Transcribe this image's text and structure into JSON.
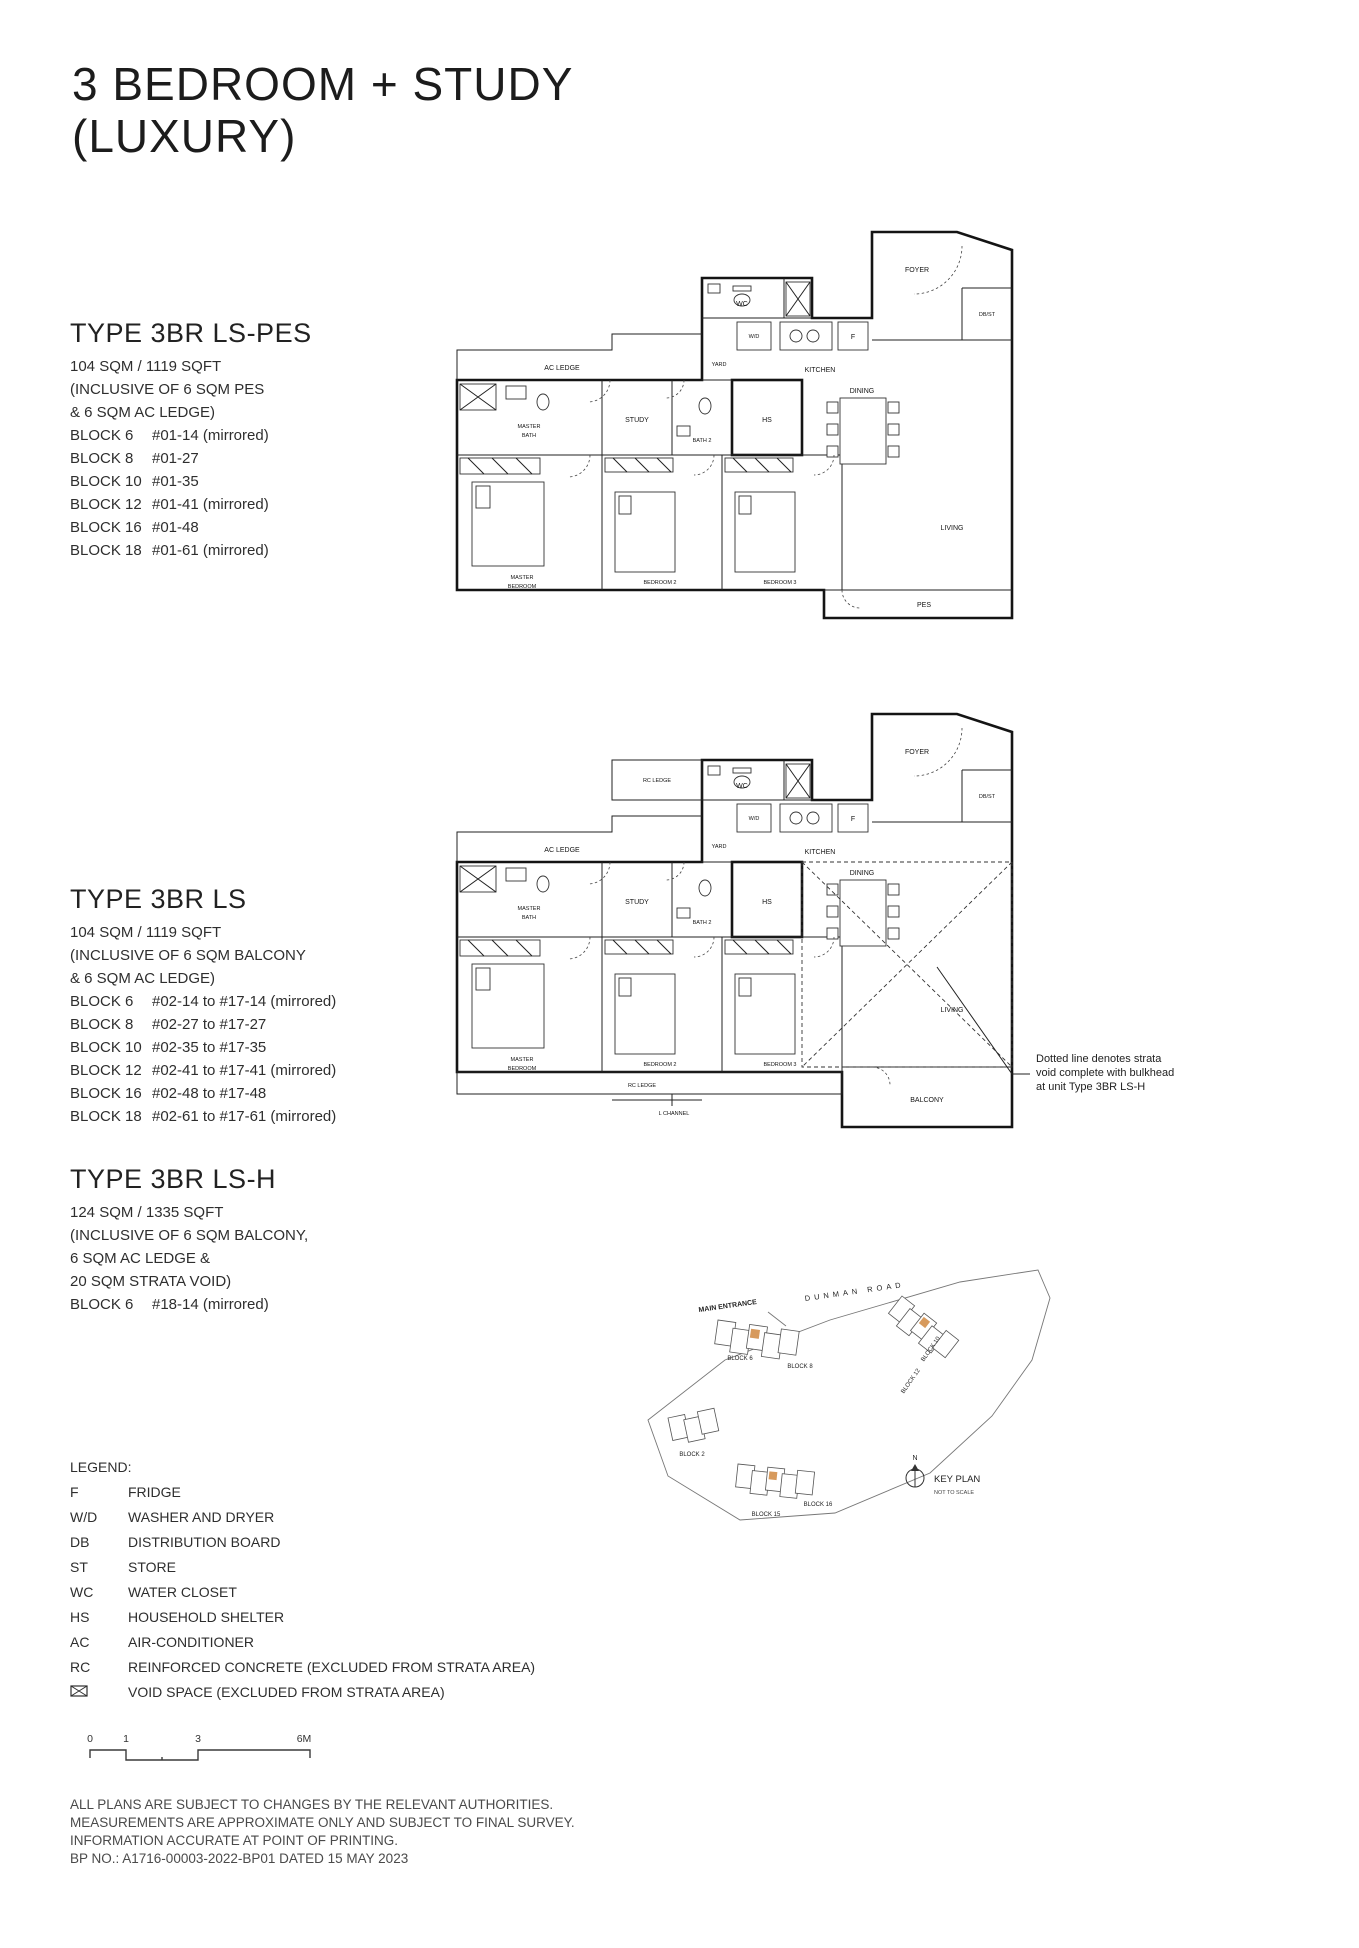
{
  "page": {
    "title_line1": "3 BEDROOM + STUDY",
    "title_line2": "(LUXURY)"
  },
  "types": [
    {
      "name": "TYPE 3BR LS-PES",
      "area": "104 SQM / 1119 SQFT",
      "inclusive": [
        "(INCLUSIVE OF 6 SQM PES",
        "& 6 SQM AC LEDGE)"
      ],
      "blocks": [
        {
          "block": "BLOCK 6",
          "units": "#01-14 (mirrored)"
        },
        {
          "block": "BLOCK 8",
          "units": "#01-27"
        },
        {
          "block": "BLOCK 10",
          "units": "#01-35"
        },
        {
          "block": "BLOCK 12",
          "units": "#01-41 (mirrored)"
        },
        {
          "block": "BLOCK 16",
          "units": "#01-48"
        },
        {
          "block": "BLOCK 18",
          "units": "#01-61 (mirrored)"
        }
      ]
    },
    {
      "name": "TYPE 3BR LS",
      "area": "104 SQM / 1119 SQFT",
      "inclusive": [
        "(INCLUSIVE OF 6 SQM BALCONY",
        "& 6 SQM AC LEDGE)"
      ],
      "blocks": [
        {
          "block": "BLOCK 6",
          "units": "#02-14 to #17-14 (mirrored)"
        },
        {
          "block": "BLOCK 8",
          "units": "#02-27 to #17-27"
        },
        {
          "block": "BLOCK 10",
          "units": "#02-35 to #17-35"
        },
        {
          "block": "BLOCK 12",
          "units": "#02-41 to #17-41 (mirrored)"
        },
        {
          "block": "BLOCK 16",
          "units": "#02-48 to #17-48"
        },
        {
          "block": "BLOCK 18",
          "units": "#02-61 to #17-61 (mirrored)"
        }
      ]
    },
    {
      "name": "TYPE 3BR LS-H",
      "area": "124 SQM / 1335 SQFT",
      "inclusive": [
        "(INCLUSIVE OF 6 SQM BALCONY,",
        "6 SQM AC LEDGE &",
        "20 SQM STRATA VOID)"
      ],
      "blocks": [
        {
          "block": "BLOCK 6",
          "units": "#18-14 (mirrored)"
        }
      ]
    }
  ],
  "plan_rooms": {
    "wc": "WC",
    "wd": "W/D",
    "fridge": "F",
    "kitchen": "KITCHEN",
    "yard": "YARD",
    "foyer": "FOYER",
    "dbst": "DB/ST",
    "ac_ledge": "AC LEDGE",
    "study": "STUDY",
    "bath2": "BATH 2",
    "hs": "HS",
    "dining": "DINING",
    "master_bath": [
      "MASTER",
      "BATH"
    ],
    "master_bedroom": [
      "MASTER",
      "BEDROOM"
    ],
    "bedroom2": "BEDROOM 2",
    "bedroom3": "BEDROOM 3",
    "living": "LIVING",
    "pes": "PES",
    "rc_ledge": "RC LEDGE",
    "l_channel": "L CHANNEL",
    "balcony": "BALCONY"
  },
  "annotation": [
    "Dotted line denotes strata",
    "void complete with bulkhead",
    "at unit Type 3BR LS-H"
  ],
  "legend": {
    "title": "LEGEND:",
    "items": [
      {
        "abbr": "F",
        "label": "FRIDGE"
      },
      {
        "abbr": "W/D",
        "label": "WASHER AND DRYER"
      },
      {
        "abbr": "DB",
        "label": "DISTRIBUTION BOARD"
      },
      {
        "abbr": "ST",
        "label": "STORE"
      },
      {
        "abbr": "WC",
        "label": "WATER CLOSET"
      },
      {
        "abbr": "HS",
        "label": "HOUSEHOLD SHELTER"
      },
      {
        "abbr": "AC",
        "label": "AIR-CONDITIONER"
      },
      {
        "abbr": "RC",
        "label": "REINFORCED CONCRETE (EXCLUDED FROM STRATA AREA)"
      }
    ],
    "void_item": {
      "label": "VOID SPACE (EXCLUDED FROM STRATA AREA)"
    }
  },
  "scalebar": {
    "ticks": [
      "0",
      "1",
      "3",
      "6M"
    ]
  },
  "keyplan": {
    "main_entrance": "MAIN ENTRANCE",
    "road": "DUNMAN ROAD",
    "blocks": [
      "BLOCK 2",
      "BLOCK 6",
      "BLOCK 8",
      "BLOCK 10",
      "BLOCK 12",
      "BLOCK 15",
      "BLOCK 16"
    ],
    "compass": "N",
    "title": "KEY PLAN",
    "subtitle": "NOT TO SCALE",
    "highlight_color": "#d79a5d"
  },
  "footer": {
    "lines": [
      "ALL PLANS ARE SUBJECT TO CHANGES BY THE RELEVANT AUTHORITIES.",
      "MEASUREMENTS ARE APPROXIMATE ONLY AND SUBJECT TO FINAL SURVEY.",
      "INFORMATION ACCURATE AT POINT OF PRINTING.",
      "BP NO.: A1716-00003-2022-BP01 DATED 15 MAY 2023"
    ]
  }
}
